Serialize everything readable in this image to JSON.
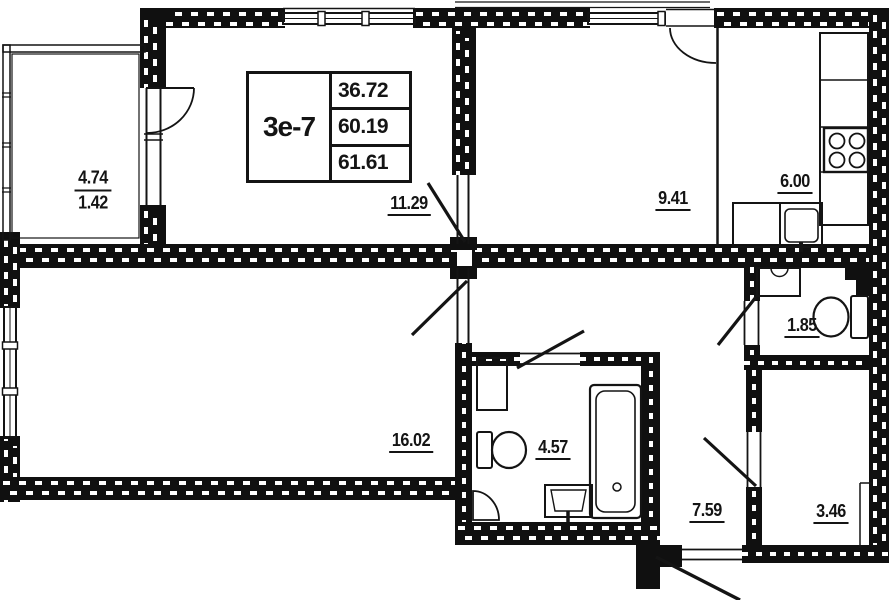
{
  "title_block": {
    "unit": "3е-7",
    "living_area": "36.72",
    "total_area": "60.19",
    "total_area_with_summer": "61.61"
  },
  "rooms": {
    "balcony": {
      "area_full": "4.74",
      "area_reduced": "1.42"
    },
    "bedroom": {
      "area": "11.29"
    },
    "room": {
      "area": "9.41"
    },
    "kitchen": {
      "area": "6.00"
    },
    "wc": {
      "area": "1.85"
    },
    "living": {
      "area": "16.02"
    },
    "bathroom": {
      "area": "4.57"
    },
    "hallway": {
      "area": "7.59"
    },
    "storage": {
      "area": "3.46"
    }
  },
  "colors": {
    "line": "#141414",
    "background": "#ffffff"
  }
}
